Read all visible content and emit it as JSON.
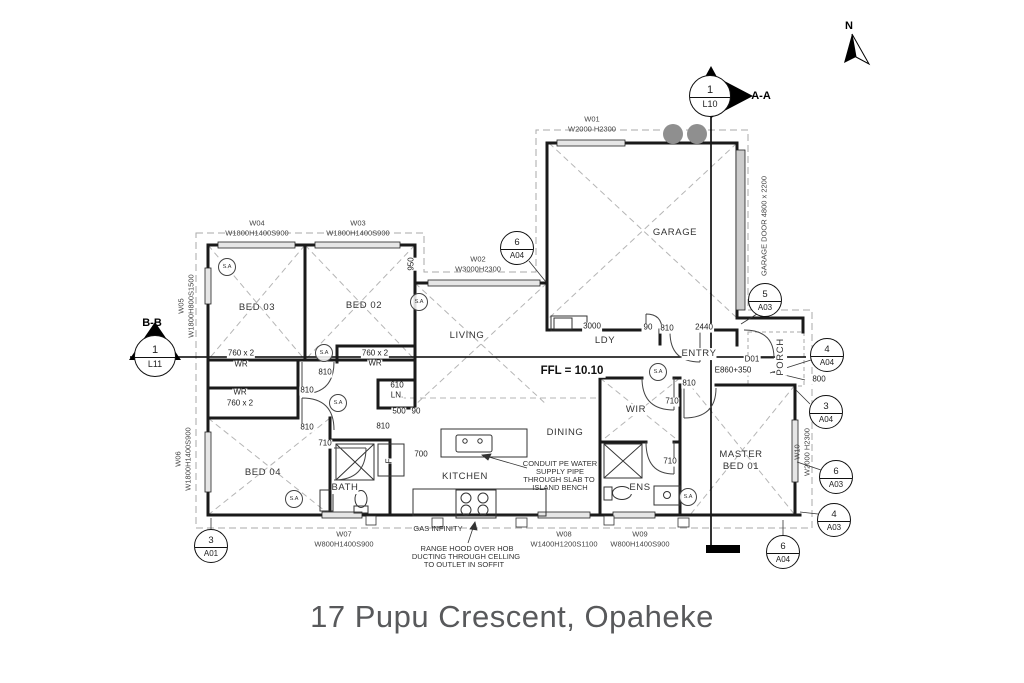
{
  "title": "17 Pupu Crescent, Opaheke",
  "compass": {
    "north": "N"
  },
  "ffl": "FFL = 10.10",
  "sections": {
    "aa": {
      "num": "1",
      "sheet": "L10",
      "label": "A-A"
    },
    "bb": {
      "num": "1",
      "sheet": "L11",
      "label": "B-B"
    }
  },
  "rooms": {
    "bed03": "BED 03",
    "bed02": "BED 02",
    "living": "LIVING",
    "garage": "GARAGE",
    "ldy": "LDY",
    "entry": "ENTRY",
    "dining": "DINING",
    "kitchen": "KITCHEN",
    "bath": "BATH",
    "ens": "ENS",
    "bed04": "BED 04",
    "wir": "WIR",
    "master1": "MASTER",
    "master2": "BED 01",
    "porch": "PORCH"
  },
  "windows": {
    "w01": {
      "id": "W01",
      "spec": "W2000 H2300"
    },
    "w02": {
      "id": "W02",
      "spec": "W3000H2300"
    },
    "w03": {
      "id": "W03",
      "spec": "W1800H1400S900"
    },
    "w04": {
      "id": "W04",
      "spec": "W1800H1400S900"
    },
    "w05": {
      "id": "W05",
      "spec": "W1800H800S1500"
    },
    "w06": {
      "id": "W06",
      "spec": "W1800H1400S900"
    },
    "w07": {
      "id": "W07",
      "spec": "W800H1400S900"
    },
    "w08": {
      "id": "W08",
      "spec": "W1400H1200S1100"
    },
    "w09": {
      "id": "W09",
      "spec": "W800H1400S900"
    },
    "w10": {
      "id": "W10",
      "spec": "W2000 H2300"
    }
  },
  "garage_door": "GARAGE DOOR 4800 x 2200",
  "doors": {
    "d01": "D01",
    "e860": "E860+350"
  },
  "ref_markers": [
    {
      "num": "6",
      "sheet": "A04"
    },
    {
      "num": "5",
      "sheet": "A03"
    },
    {
      "num": "4",
      "sheet": "A04"
    },
    {
      "num": "3",
      "sheet": "A04"
    },
    {
      "num": "6",
      "sheet": "A03"
    },
    {
      "num": "4",
      "sheet": "A03"
    },
    {
      "num": "6",
      "sheet": "A04"
    },
    {
      "num": "3",
      "sheet": "A01"
    }
  ],
  "dims": {
    "v950": "950",
    "h3000": "3000",
    "h90_entry": "90",
    "h810_entry": "810",
    "h2440": "2440",
    "h810_master": "810",
    "h710_wir": "710",
    "h810_hall_top": "810",
    "h810_hall_a": "810",
    "h810_hall_b": "810",
    "h810_bed02": "810",
    "h610": "610",
    "ln": "LN.",
    "h500": "500",
    "h90_ln": "90",
    "h710_bath": "710",
    "h710_ens": "710",
    "h700": "700",
    "h800": "800",
    "f": "F"
  },
  "wardrobes": {
    "a1": "760 x 2",
    "a2": "WR",
    "b1": "WR",
    "b2": "760 x 2",
    "c1": "760 x 2",
    "c2": "WR"
  },
  "labels": {
    "sa": "S.A"
  },
  "notes": {
    "gas": "GAS INFINITY",
    "range1": "RANGE HOOD OVER HOB",
    "range2": "DUCTING THROUGH CELLING",
    "range3": "TO OUTLET IN SOFFIT",
    "conduit1": "CONDUIT PE WATER",
    "conduit2": "SUPPLY PIPE",
    "conduit3": "THROUGH SLAB TO",
    "conduit4": "ISLAND BENCH"
  }
}
